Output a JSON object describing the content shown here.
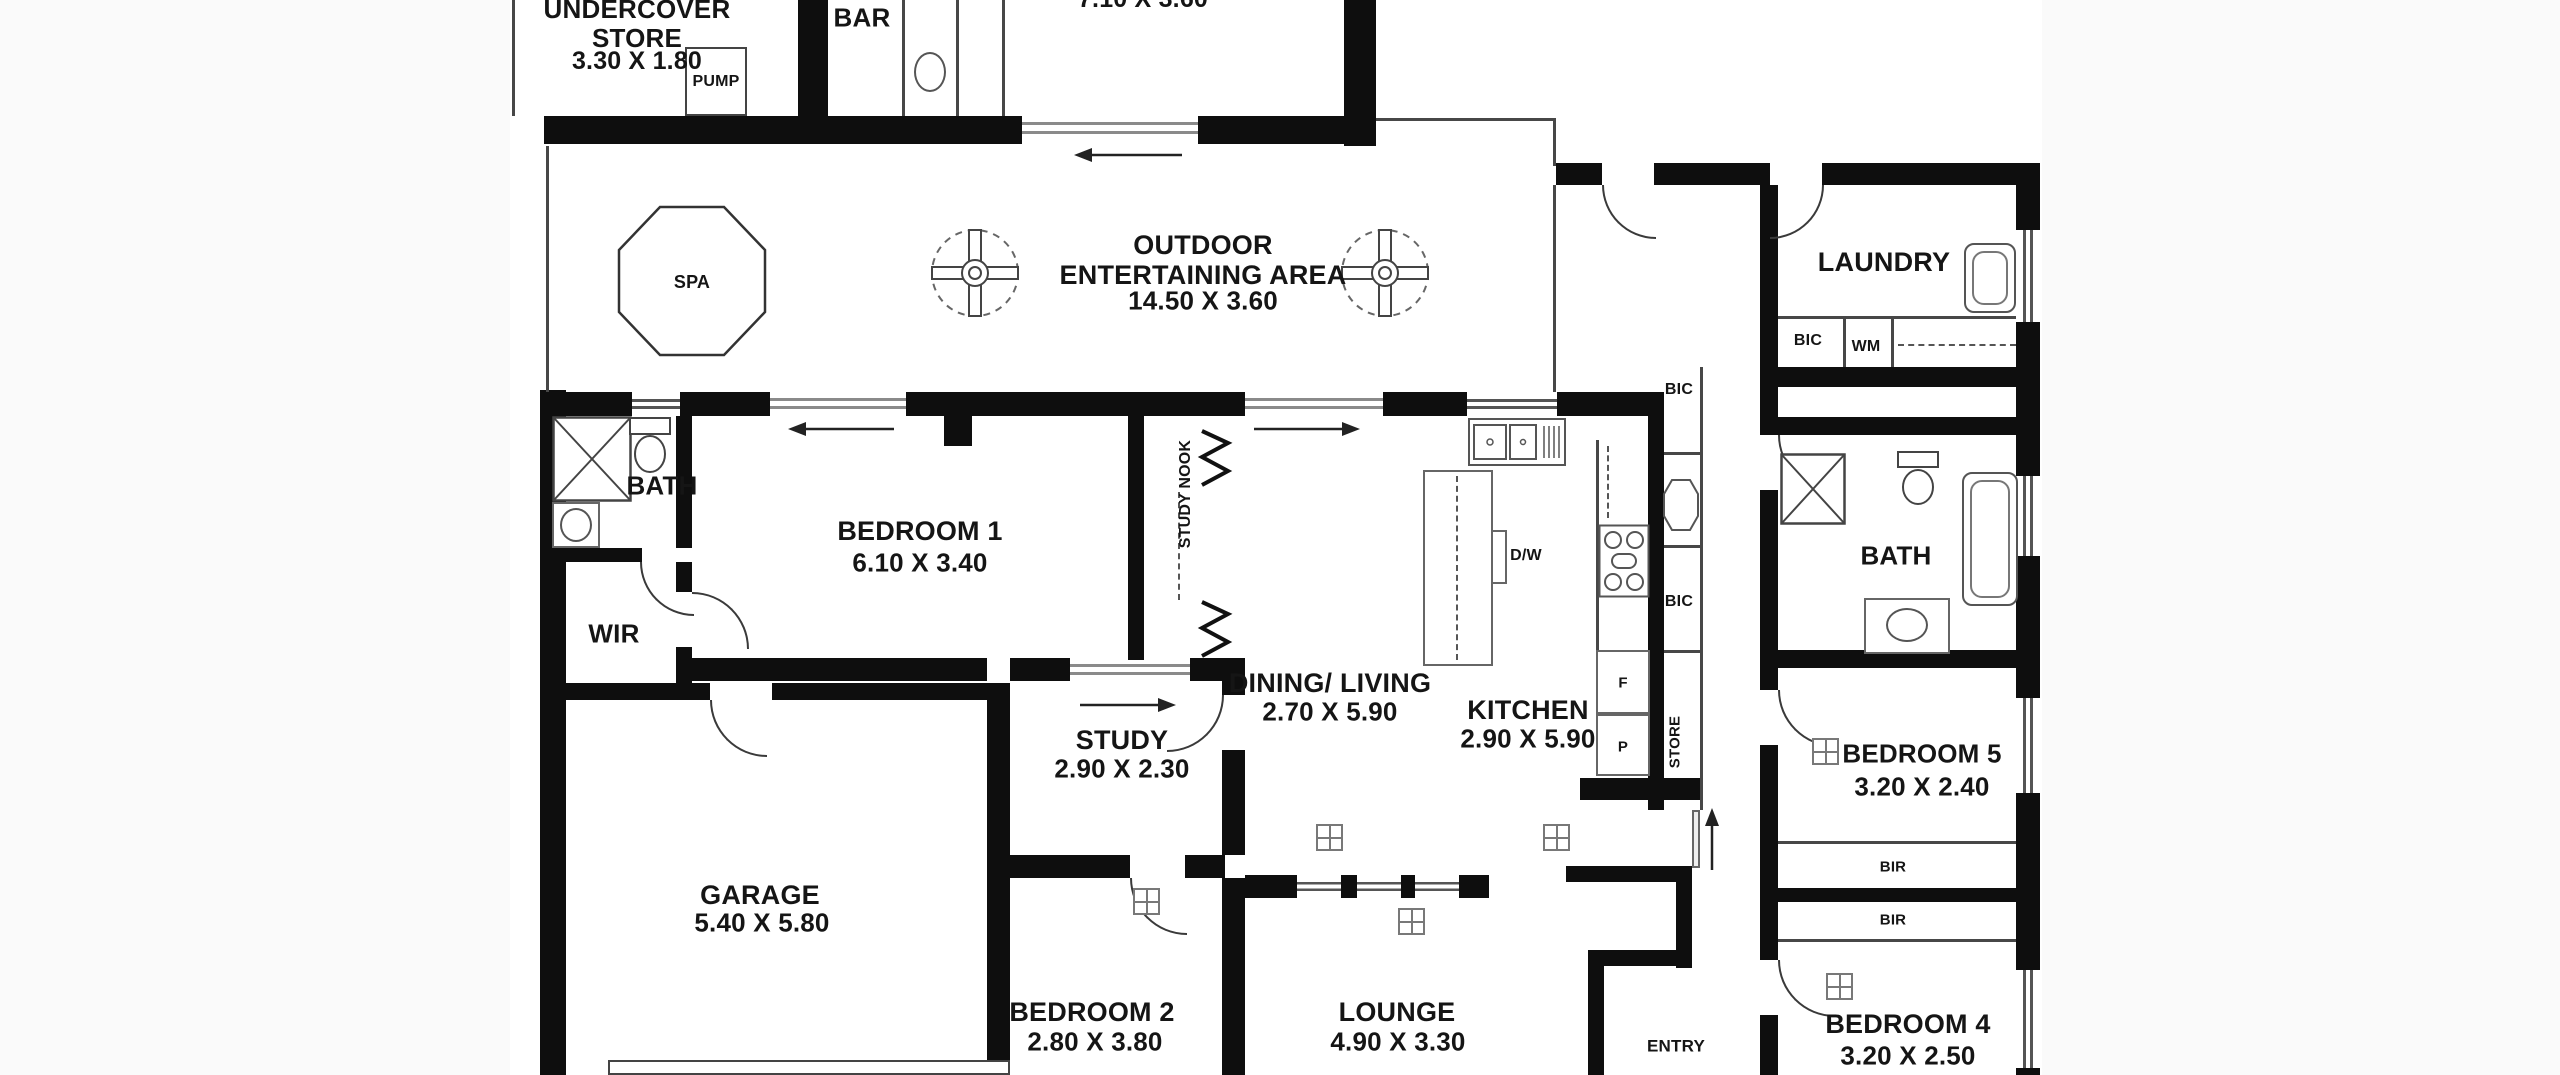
{
  "rooms": {
    "undercover_store": {
      "name": "UNDERCOVER\nSTORE",
      "dim": "3.30 X 1.80"
    },
    "pump": {
      "name": "PUMP"
    },
    "bar": {
      "name": "BAR"
    },
    "top_room": {
      "dim": "7.10 X 3.60"
    },
    "outdoor": {
      "name": "OUTDOOR\nENTERTAINING AREA",
      "dim": "14.50 X 3.60"
    },
    "spa": {
      "name": "SPA"
    },
    "laundry": {
      "name": "LAUNDRY"
    },
    "bath_left": {
      "name": "BATH"
    },
    "wir": {
      "name": "WIR"
    },
    "bedroom1": {
      "name": "BEDROOM 1",
      "dim": "6.10 X 3.40"
    },
    "study_nook": {
      "name": "STUDY NOOK"
    },
    "dining_living": {
      "name": "DINING/ LIVING",
      "dim": "2.70 X 5.90"
    },
    "kitchen": {
      "name": "KITCHEN",
      "dim": "2.90 X 5.90"
    },
    "study": {
      "name": "STUDY",
      "dim": "2.90 X 2.30"
    },
    "garage": {
      "name": "GARAGE",
      "dim": "5.40 X 5.80"
    },
    "bedroom2": {
      "name": "BEDROOM 2",
      "dim": "2.80 X 3.80"
    },
    "lounge": {
      "name": "LOUNGE",
      "dim": "4.90 X 3.30"
    },
    "entry": {
      "name": "ENTRY"
    },
    "bath_right": {
      "name": "BATH"
    },
    "bedroom5": {
      "name": "BEDROOM 5",
      "dim": "3.20 X 2.40"
    },
    "bedroom4": {
      "name": "BEDROOM 4",
      "dim": "3.20 X 2.50"
    }
  },
  "fixtures": {
    "bic": "BIC",
    "wm": "WM",
    "store": "STORE",
    "bir": "BIR",
    "f": "F",
    "p": "P",
    "dw": "D/W"
  },
  "colors": {
    "wall": "#0e0e0e",
    "line": "#474747",
    "background": "#ffffff"
  }
}
